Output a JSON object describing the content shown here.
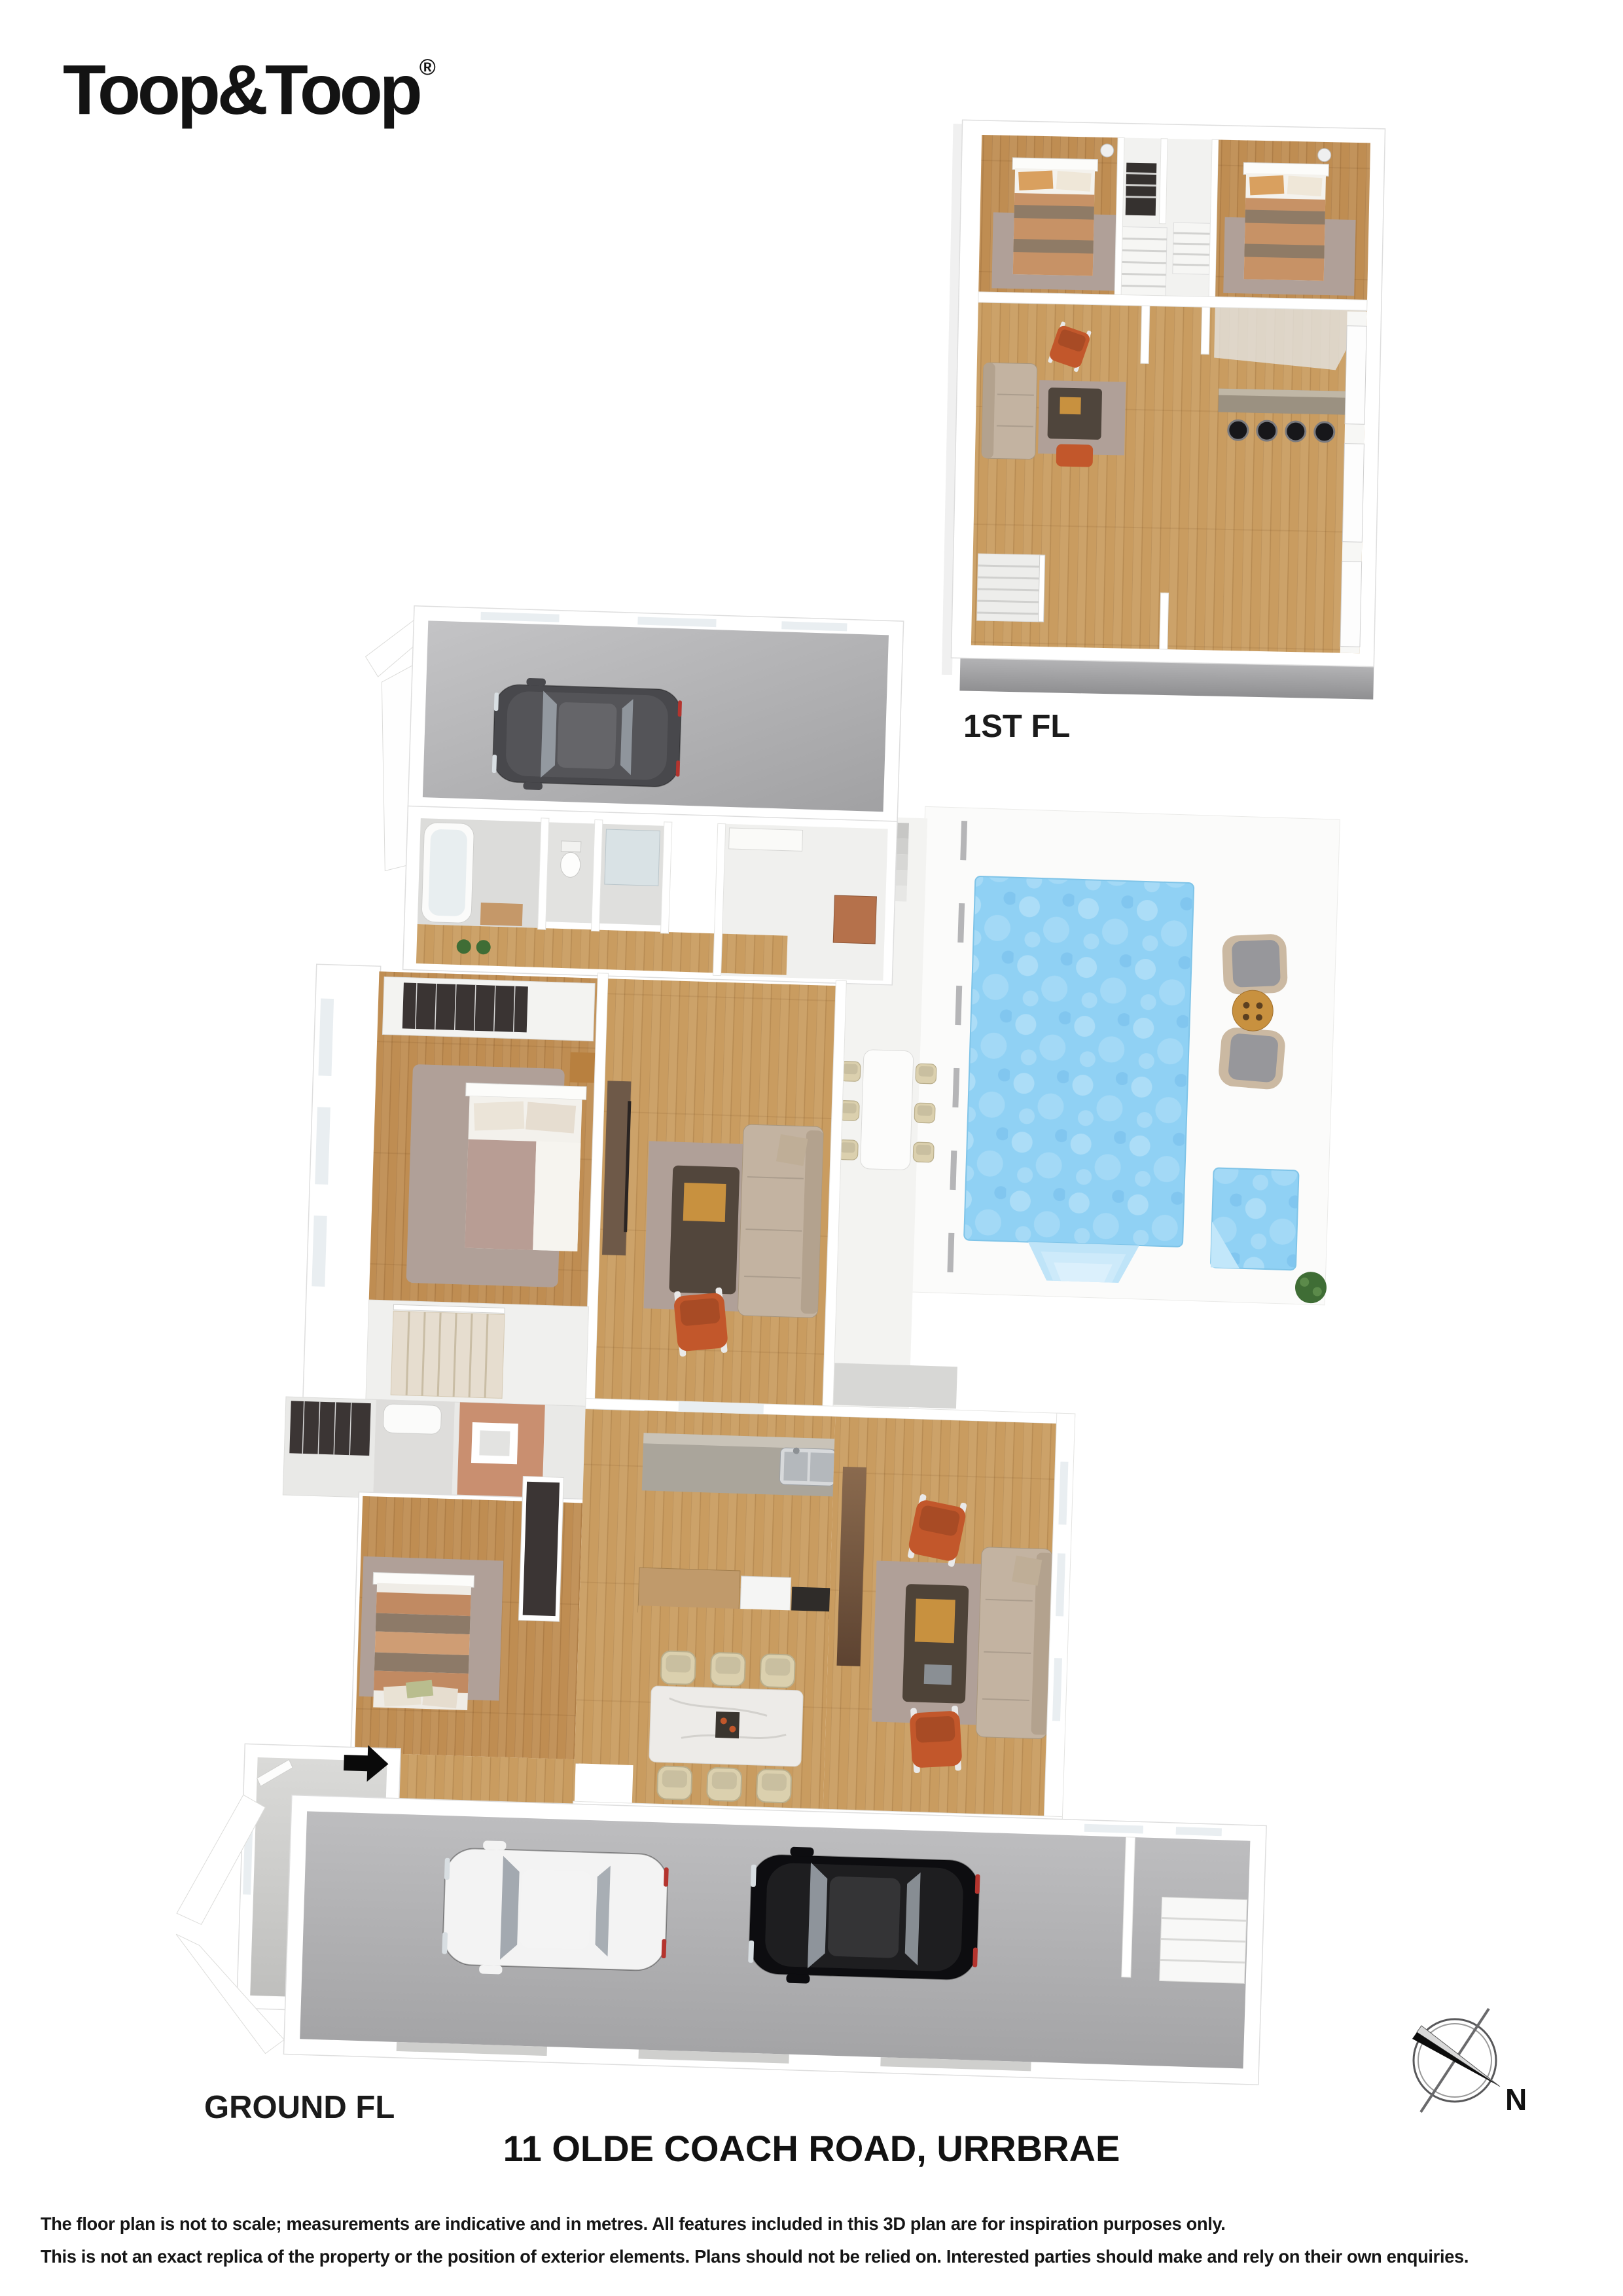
{
  "logo": {
    "text": "Toop&Toop",
    "registered": "®"
  },
  "floors": {
    "first": {
      "label": "1ST FL"
    },
    "ground": {
      "label": "GROUND FL"
    }
  },
  "address": "11 OLDE COACH ROAD, URRBRAE",
  "disclaimer": {
    "line1": "The floor plan is not to scale; measurements are indicative and in metres. All features included in this 3D plan are for inspiration purposes only.",
    "line2": "This is not an exact replica of the property or the position of exterior elements. Plans should not be relied on. Interested parties should make and rely on their own enquiries."
  },
  "compass": {
    "north_label": "N"
  },
  "colors": {
    "page_bg": "#ffffff",
    "text": "#111111",
    "wood_main": "#c99c60",
    "wood_dark": "#bf8d52",
    "rug": "#b0a098",
    "quilt": "#b89d94",
    "orange": "#c2572b",
    "pool_blue": "#90d1f4",
    "garage_floor": "#b0b0b2",
    "car_gray": "#48484c",
    "car_black": "#0d0d10",
    "car_white": "#f3f3f3",
    "chair_cream": "#dbd0ae",
    "timber": "#c8913f",
    "sofa": "#c3b3a1",
    "plant": "#3f6d35"
  }
}
